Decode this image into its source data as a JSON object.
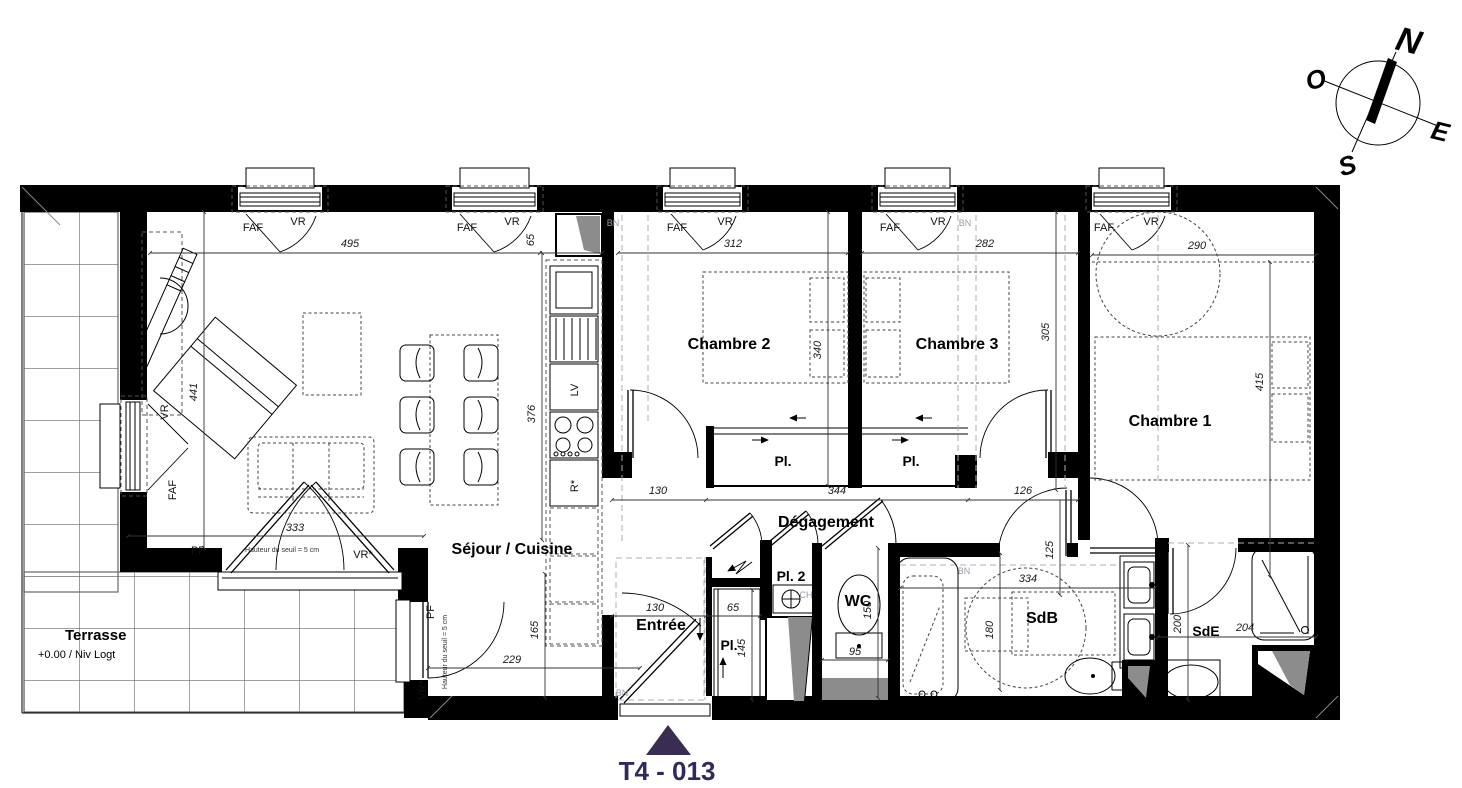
{
  "plan": {
    "title": "T4 - 013",
    "rooms": {
      "sejour": "Séjour / Cuisine",
      "terrasse": "Terrasse",
      "terrasse_level": "+0.00 / Niv Logt",
      "entree": "Entrée",
      "chambre1": "Chambre 1",
      "chambre2": "Chambre 2",
      "chambre3": "Chambre 3",
      "degagement": "Dégagement",
      "pl": "Pl.",
      "pl2": "Pl. 2",
      "wc": "WC",
      "sdb": "SdB",
      "sde": "SdE"
    },
    "labels": {
      "faf": "FAF",
      "vr": "VR",
      "vr_star": "VR*",
      "pf": "PF",
      "bn": "BN",
      "lv": "LV",
      "r_star": "R*",
      "ch": "CH",
      "seuil": "Hauteur du seuil = 5 cm"
    },
    "dims": {
      "d495": "495",
      "d65": "65",
      "d312": "312",
      "d282": "282",
      "d290": "290",
      "d441": "441",
      "d376": "376",
      "d165": "165",
      "d340": "340",
      "d305": "305",
      "d415": "415",
      "d333": "333",
      "d229": "229",
      "d130": "130",
      "d344": "344",
      "d126": "126",
      "d125": "125",
      "d145": "145",
      "d95": "95",
      "d150": "150",
      "d334": "334",
      "d180": "180",
      "d200": "200",
      "d204": "204"
    },
    "compass": {
      "n": "N",
      "s": "S",
      "e": "E",
      "o": "O"
    },
    "colors": {
      "title": "#2f2a5e",
      "marker": "#3a2d52",
      "wall": "#000000",
      "shaft_gray": "#8c8c8c"
    }
  }
}
